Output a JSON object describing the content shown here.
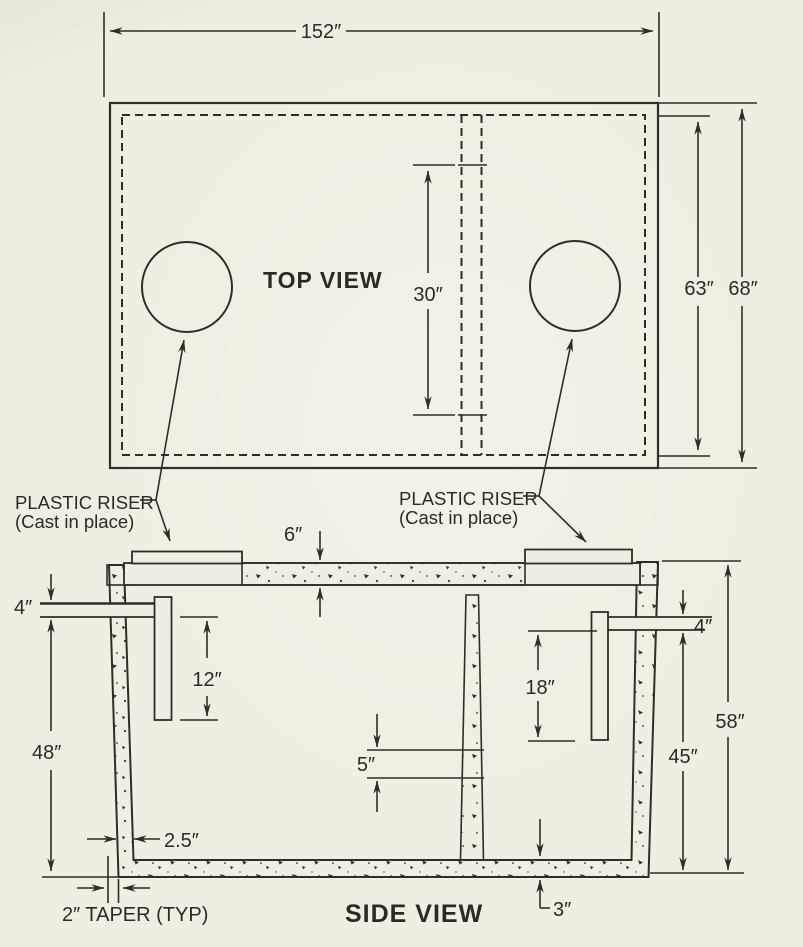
{
  "palette": {
    "paper": "#f0ede2",
    "ink": "#2f2d27"
  },
  "top_view": {
    "title": "TOP VIEW",
    "dim_overall_length": "152″",
    "dim_access_opening": "30″",
    "dim_inner_width": "63″",
    "dim_outer_width": "68″"
  },
  "side_view": {
    "title": "SIDE VIEW",
    "dim_lid_thickness": "6″",
    "dim_inlet_pipe": "4″",
    "dim_inlet_baffle": "12″",
    "dim_inlet_depth": "48″",
    "dim_baffle_slot": "5″",
    "dim_outlet_pipe": "4″",
    "dim_outlet_baffle": "18″",
    "dim_outlet_depth": "45″",
    "dim_overall_height": "58″",
    "dim_wall_thickness": "2.5″",
    "dim_floor_thickness": "3″",
    "label_taper": "2″ TAPER (TYP)"
  },
  "callouts": {
    "riser_left": {
      "line1": "PLASTIC RISER",
      "line2": "(Cast in place)"
    },
    "riser_right": {
      "line1": "PLASTIC RISER",
      "line2": "(Cast in place)"
    }
  }
}
